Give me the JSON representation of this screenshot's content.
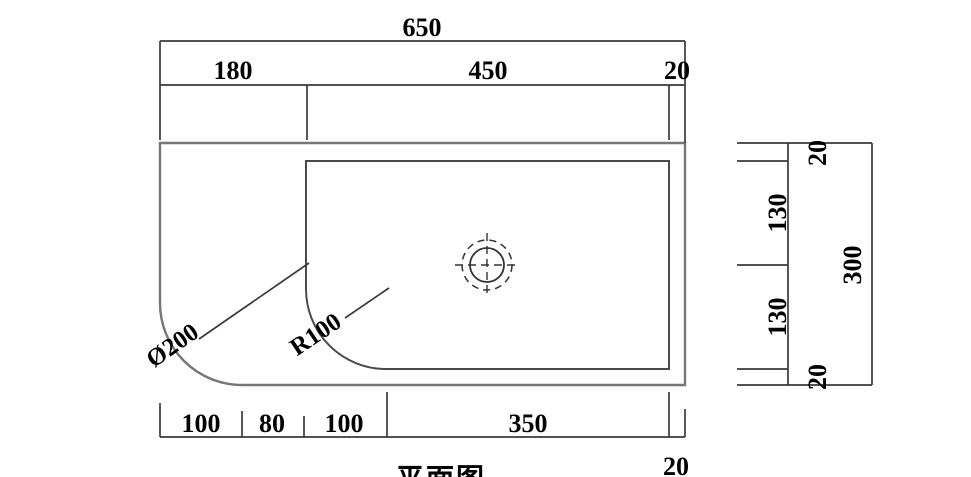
{
  "canvas": {
    "background": "#ffffff",
    "line_color": "#3a3a3a",
    "text_color": "#000000"
  },
  "plan_view": {
    "top_dimensions": {
      "total": "650",
      "segments": [
        "180",
        "450",
        "20"
      ]
    },
    "bottom_dimensions": {
      "segments": [
        "100",
        "80",
        "100",
        "350",
        "20"
      ]
    },
    "corner_labels": {
      "outer_diameter": "Ø200",
      "inner_radius": "R100"
    }
  },
  "side_scale": {
    "segments": [
      "20",
      "130",
      "130",
      "20"
    ],
    "total": "300"
  },
  "caption": {
    "title": "平面图"
  }
}
